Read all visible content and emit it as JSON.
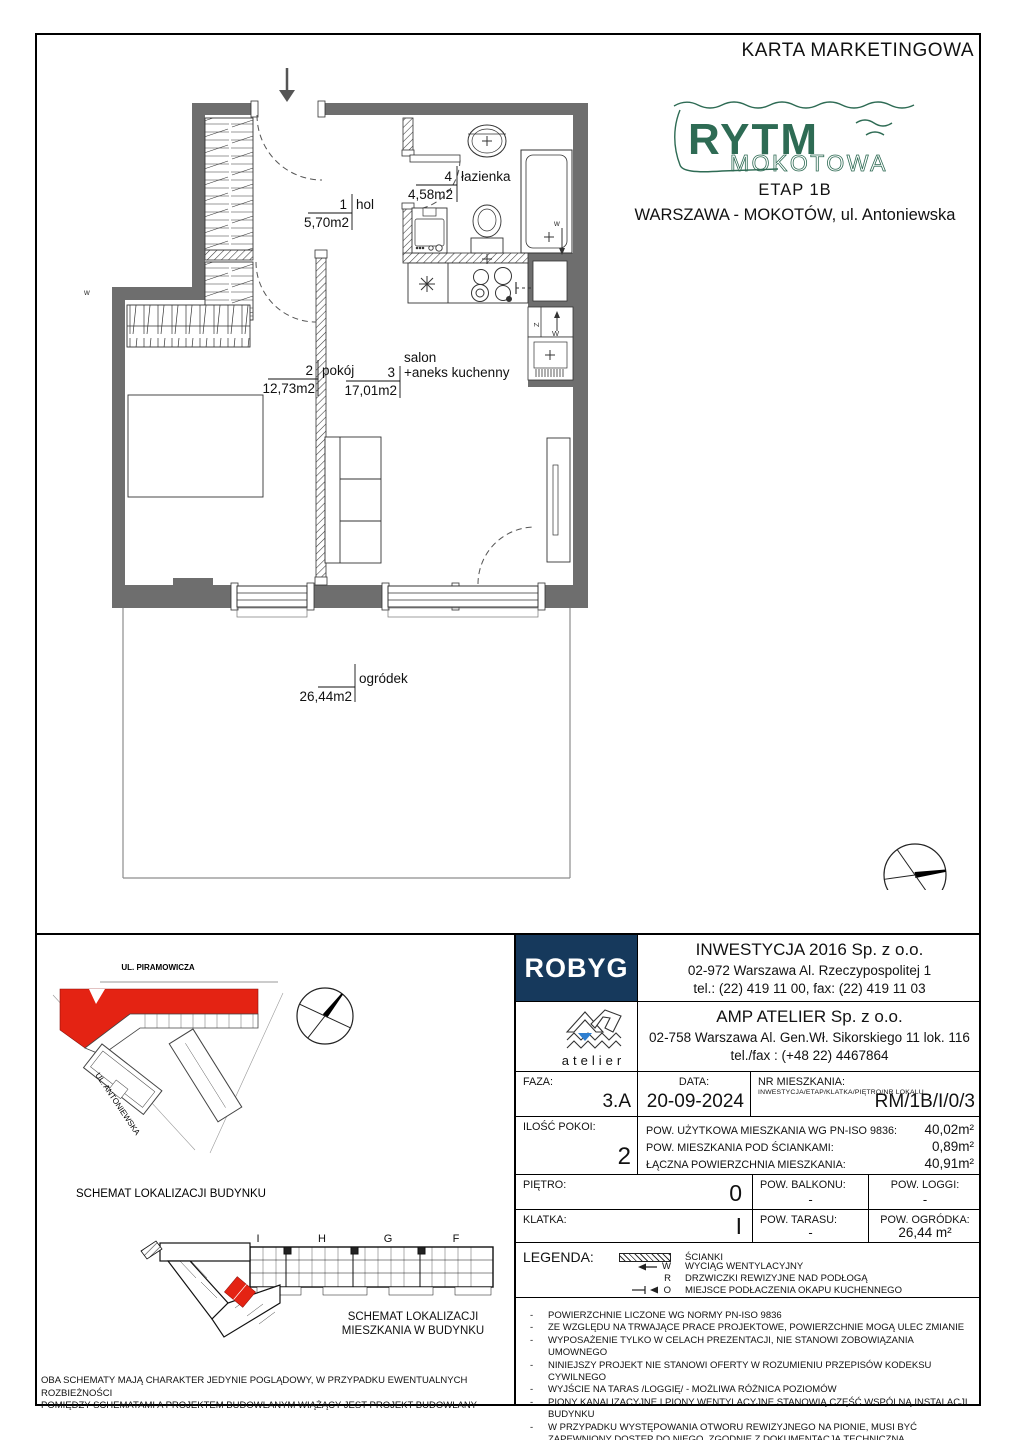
{
  "page": {
    "title": "KARTA MARKETINGOWA"
  },
  "branding": {
    "logo_main": "RYTM",
    "logo_sub": "MOKOTOWA",
    "etap": "ETAP 1B",
    "address": "WARSZAWA - MOKOTÓW, ul. Antoniewska",
    "green": "#2e6b54"
  },
  "plan": {
    "wall_color": "#6e6e6e",
    "rooms": [
      {
        "number": "1",
        "name": "hol",
        "area": "5,70m2"
      },
      {
        "number": "2",
        "name": "pokój",
        "area": "12,73m2"
      },
      {
        "number": "3",
        "prefix": "salon",
        "name": "+aneks kuchenny",
        "area": "17,01m2"
      },
      {
        "number": "4",
        "name": "łazienka",
        "area": "4,58m2"
      }
    ],
    "garden": {
      "name": "ogródek",
      "area": "26,44m2"
    },
    "marks": {
      "z": "Z",
      "w": "W",
      "w_small": "w"
    }
  },
  "site_schematic": {
    "street_top": "UL. PIRAMOWICZA",
    "street_left": "UL. ANTONIEWSKA",
    "caption": "SCHEMAT LOKALIZACJI BUDYNKU",
    "highlight_color": "#e42313"
  },
  "apartment_schematic": {
    "sections": [
      "I",
      "H",
      "G",
      "F"
    ],
    "caption_line1": "SCHEMAT LOKALIZACJI",
    "caption_line2": "MIESZKANIA W BUDYNKU",
    "note_line1": "OBA SCHEMATY MAJĄ CHARAKTER JEDYNIE POGLĄDOWY, W PRZYPADKU EWENTUALNYCH ROZBIEŻNOŚCI",
    "note_line2": "POMIĘDZY SCHEMATAMI A PROJEKTEM BUDOWLANYM WIĄŻĄCY JEST PROJEKT BUDOWLANY"
  },
  "titleblock": {
    "developer": {
      "logo": "ROBYG",
      "navy": "#16395c",
      "name": "INWESTYCJA 2016 Sp. z o.o.",
      "address": "02-972 Warszawa Al. Rzeczypospolitej 1",
      "phone": "tel.: (22) 419 11 00, fax: (22) 419 11 03"
    },
    "architect": {
      "logo_text": "atelier",
      "name": "AMP ATELIER Sp. z o.o.",
      "address": "02-758 Warszawa  Al. Gen.Wł. Sikorskiego 11 lok. 116",
      "phone": "tel./fax : (+48 22) 4467864"
    },
    "faza": {
      "label": "FAZA:",
      "value": "3.A"
    },
    "data": {
      "label": "DATA:",
      "value": "20-09-2024"
    },
    "nr": {
      "label": "NR MIESZKANIA:",
      "sublabel": "INWESTYCJA/ETAP/KLATKA/PIĘTRO/NR LOKALU",
      "value": "RM/1B/I/0/3"
    },
    "rooms_count": {
      "label": "ILOŚĆ POKOI:",
      "value": "2"
    },
    "areas": [
      {
        "label": "POW. UŻYTKOWA MIESZKANIA WG PN-ISO 9836:",
        "value": "40,02m²"
      },
      {
        "label": "POW. MIESZKANIA POD ŚCIANKAMI:",
        "value": "0,89m²"
      },
      {
        "label": "ŁĄCZNA POWIERZCHNIA MIESZKANIA:",
        "value": "40,91m²"
      }
    ],
    "pietro": {
      "label": "PIĘTRO:",
      "value": "0"
    },
    "balkon": {
      "label": "POW. BALKONU:",
      "value": "-"
    },
    "loggia": {
      "label": "POW. LOGGI:",
      "value": "-"
    },
    "klatka": {
      "label": "KLATKA:",
      "value": "I"
    },
    "taras": {
      "label": "POW. TARASU:",
      "value": "-"
    },
    "ogrodek": {
      "label": "POW. OGRÓDKA:",
      "value": "26,44 m²"
    },
    "legend": {
      "label": "LEGENDA:",
      "items": [
        {
          "symbol": "hatch",
          "letter": "",
          "text": "ŚCIANKI"
        },
        {
          "symbol": "arrow-w",
          "letter": "W",
          "text": "WYCIĄG WENTYLACYJNY"
        },
        {
          "symbol": "r",
          "letter": "R",
          "text": "DRZWICZKI REWIZYJNE NAD PODŁOGĄ"
        },
        {
          "symbol": "arrow-o",
          "letter": "O",
          "text": "MIEJSCE PODŁACZENIA OKAPU KUCHENNEGO"
        }
      ]
    },
    "notes": [
      "POWIERZCHNIE LICZONE WG NORMY PN-ISO 9836",
      "ZE WZGLĘDU NA TRWAJĄCE PRACE PROJEKTOWE, POWIERZCHNIE MOGĄ ULEC ZMIANIE",
      "WYPOSAŻENIE TYLKO W CELACH PREZENTACJI, NIE STANOWI ZOBOWIĄZANIA UMOWNEGO",
      "NINIEJSZY PROJEKT NIE STANOWI OFERTY W ROZUMIENIU PRZEPISÓW KODEKSU  CYWILNEGO",
      "WYJŚCIE NA TARAS /LOGGIĘ/ - MOŻLIWA RÓŻNICA POZIOMÓW",
      "PIONY KANALIZACYJNE I PIONY WENTYLACYJNE STANOWIĄ CZĘŚĆ WSPÓLNĄ INSTALACJI BUDYNKU",
      "W PRZYPADKU WYSTĘPOWANIA OTWORU REWIZYJNEGO NA PIONIE, MUSI BYĆ ZAPEWNIONY DOSTĘP DO NIEGO, ZGODNIE Z DOKUMENTACJĄ TECHNICZNĄ"
    ]
  }
}
